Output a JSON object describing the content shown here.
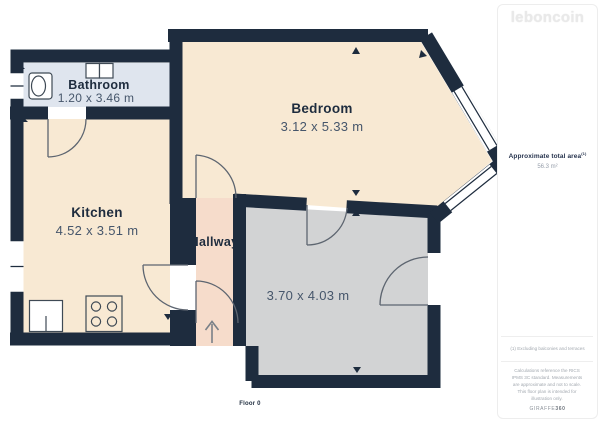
{
  "brand": {
    "logo_text": "leboncoin"
  },
  "plan": {
    "floor_label": "Floor 0",
    "rooms": [
      {
        "name": "Bathroom",
        "dimensions": "1.20 x 3.46 m"
      },
      {
        "name": "Bedroom",
        "dimensions": "3.12 x 5.33 m"
      },
      {
        "name": "Kitchen",
        "dimensions": "4.52 x 3.51 m"
      },
      {
        "name": "Hallway",
        "dimensions": ""
      },
      {
        "name": "",
        "dimensions": "3.70 x 4.03 m"
      }
    ]
  },
  "sidebar": {
    "area_label": "Approximate total area",
    "area_superscript": "(1)",
    "area_value": "56.3 m²",
    "footnote": "(1) Excluding balconies and terraces",
    "disclaimer": "Calculations reference the RICS IPMS 3C standard. Measurements are approximate and not to scale. This floor plan is intended for illustration only.",
    "provider_name": "GIRAFFE",
    "provider_suffix": "360"
  },
  "colors": {
    "wall": "#1e2c3e",
    "bathroom_fill": "#dfe5ee",
    "bedroom_fill": "#f8e9d3",
    "kitchen_fill": "#f8e9d3",
    "hallway_fill": "#f6dccb",
    "gray_room_fill": "#d2d3d4",
    "door_line": "#5d6570",
    "fixture_line": "#3f4a55",
    "room_name_text": "#1e2c3e",
    "dimension_text": "#46566b"
  }
}
